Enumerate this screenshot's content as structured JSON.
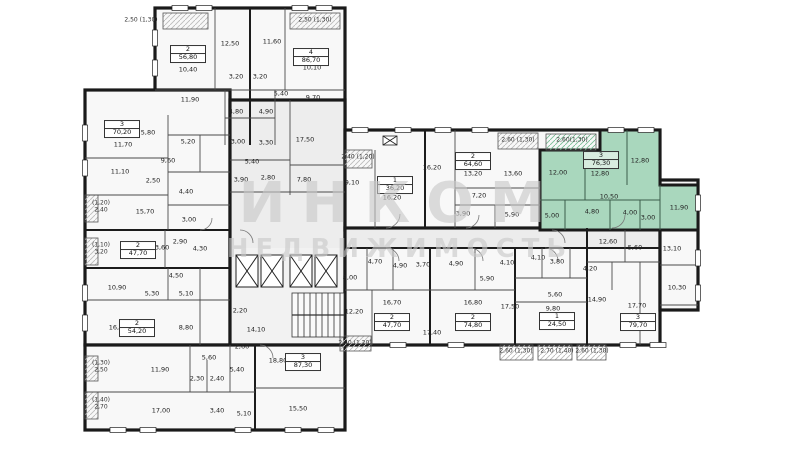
{
  "watermark": {
    "line1": "ИНКОМ",
    "line2": "НЕДВИЖИМОСТЬ"
  },
  "colors": {
    "highlight_fill": "#a9d7bd",
    "wall": "#1a1a1a",
    "watermark": "#c9c9c9"
  },
  "selected_apartment": {
    "rooms": "3",
    "area": "76,30"
  },
  "apartments": [
    {
      "n": "2",
      "a": "56,80",
      "x": 188,
      "y": 54
    },
    {
      "n": "4",
      "a": "86,70",
      "x": 311,
      "y": 57
    },
    {
      "n": "3",
      "a": "70,20",
      "x": 122,
      "y": 129
    },
    {
      "n": "2",
      "a": "47,70",
      "x": 138,
      "y": 250
    },
    {
      "n": "2",
      "a": "54,20",
      "x": 137,
      "y": 328
    },
    {
      "n": "3",
      "a": "87,30",
      "x": 303,
      "y": 362
    },
    {
      "n": "1",
      "a": "36,20",
      "x": 395,
      "y": 185
    },
    {
      "n": "2",
      "a": "64,60",
      "x": 473,
      "y": 161
    },
    {
      "n": "3",
      "a": "76,30",
      "x": 601,
      "y": 160,
      "h": true
    },
    {
      "n": "2",
      "a": "47,70",
      "x": 392,
      "y": 322
    },
    {
      "n": "2",
      "a": "74,80",
      "x": 473,
      "y": 322
    },
    {
      "n": "1",
      "a": "24,50",
      "x": 557,
      "y": 321
    },
    {
      "n": "3",
      "a": "79,70",
      "x": 638,
      "y": 322
    }
  ],
  "rooms": [
    {
      "t": "12,50",
      "x": 230,
      "y": 44
    },
    {
      "t": "11,60",
      "x": 272,
      "y": 42
    },
    {
      "t": "10,40",
      "x": 188,
      "y": 70
    },
    {
      "t": "10,10",
      "x": 312,
      "y": 68
    },
    {
      "t": "11,90",
      "x": 190,
      "y": 100
    },
    {
      "t": "3,20",
      "x": 236,
      "y": 77
    },
    {
      "t": "3,20",
      "x": 260,
      "y": 77
    },
    {
      "t": "5,40",
      "x": 281,
      "y": 94
    },
    {
      "t": "9,70",
      "x": 313,
      "y": 98
    },
    {
      "t": "4,80",
      "x": 236,
      "y": 112
    },
    {
      "t": "4,90",
      "x": 266,
      "y": 112
    },
    {
      "t": "3,00",
      "x": 238,
      "y": 142
    },
    {
      "t": "3,30",
      "x": 266,
      "y": 143
    },
    {
      "t": "17,50",
      "x": 305,
      "y": 140
    },
    {
      "t": "5,40",
      "x": 252,
      "y": 162
    },
    {
      "t": "2,80",
      "x": 268,
      "y": 178
    },
    {
      "t": "3,90",
      "x": 241,
      "y": 180
    },
    {
      "t": "7,80",
      "x": 304,
      "y": 180
    },
    {
      "t": "9,10",
      "x": 352,
      "y": 183
    },
    {
      "t": "5,80",
      "x": 148,
      "y": 133
    },
    {
      "t": "11,70",
      "x": 123,
      "y": 145
    },
    {
      "t": "5,20",
      "x": 188,
      "y": 142
    },
    {
      "t": "9,60",
      "x": 168,
      "y": 161
    },
    {
      "t": "11,10",
      "x": 120,
      "y": 172
    },
    {
      "t": "2,50",
      "x": 153,
      "y": 181
    },
    {
      "t": "4,40",
      "x": 186,
      "y": 192
    },
    {
      "t": "15,70",
      "x": 145,
      "y": 212
    },
    {
      "t": "3,00",
      "x": 189,
      "y": 220
    },
    {
      "t": "13,60",
      "x": 160,
      "y": 248
    },
    {
      "t": "2,90",
      "x": 180,
      "y": 242
    },
    {
      "t": "4,30",
      "x": 200,
      "y": 249
    },
    {
      "t": "4,50",
      "x": 176,
      "y": 276
    },
    {
      "t": "10,90",
      "x": 117,
      "y": 288
    },
    {
      "t": "5,30",
      "x": 152,
      "y": 294
    },
    {
      "t": "5,10",
      "x": 186,
      "y": 294
    },
    {
      "t": "16,50",
      "x": 118,
      "y": 328
    },
    {
      "t": "8,80",
      "x": 186,
      "y": 328
    },
    {
      "t": "2,20",
      "x": 240,
      "y": 311
    },
    {
      "t": "14,10",
      "x": 256,
      "y": 330
    },
    {
      "t": "11,90",
      "x": 160,
      "y": 370
    },
    {
      "t": "5,60",
      "x": 209,
      "y": 358
    },
    {
      "t": "2,60",
      "x": 242,
      "y": 347
    },
    {
      "t": "2,30",
      "x": 197,
      "y": 379
    },
    {
      "t": "2,40",
      "x": 217,
      "y": 379
    },
    {
      "t": "5,40",
      "x": 237,
      "y": 370
    },
    {
      "t": "18,80",
      "x": 278,
      "y": 361
    },
    {
      "t": "15,50",
      "x": 298,
      "y": 409
    },
    {
      "t": "17,00",
      "x": 161,
      "y": 411
    },
    {
      "t": "3,40",
      "x": 217,
      "y": 411
    },
    {
      "t": "5,10",
      "x": 244,
      "y": 414
    },
    {
      "t": "16,20",
      "x": 392,
      "y": 198
    },
    {
      "t": "16,20",
      "x": 432,
      "y": 168
    },
    {
      "t": "13,20",
      "x": 473,
      "y": 174
    },
    {
      "t": "13,60",
      "x": 513,
      "y": 174
    },
    {
      "t": "7,20",
      "x": 479,
      "y": 196
    },
    {
      "t": "3,90",
      "x": 463,
      "y": 214
    },
    {
      "t": "5,90",
      "x": 512,
      "y": 215
    },
    {
      "t": "12,00",
      "x": 558,
      "y": 173
    },
    {
      "t": "12,80",
      "x": 600,
      "y": 174
    },
    {
      "t": "12,80",
      "x": 640,
      "y": 161
    },
    {
      "t": "10,50",
      "x": 609,
      "y": 197
    },
    {
      "t": "4,80",
      "x": 592,
      "y": 212
    },
    {
      "t": "4,00",
      "x": 630,
      "y": 213
    },
    {
      "t": "3,00",
      "x": 648,
      "y": 218
    },
    {
      "t": "5,00",
      "x": 552,
      "y": 216
    },
    {
      "t": "11,90",
      "x": 679,
      "y": 208
    },
    {
      "t": "8,00",
      "x": 350,
      "y": 278
    },
    {
      "t": "4,70",
      "x": 375,
      "y": 262
    },
    {
      "t": "4,90",
      "x": 400,
      "y": 266
    },
    {
      "t": "12,20",
      "x": 354,
      "y": 312
    },
    {
      "t": "16,70",
      "x": 392,
      "y": 303
    },
    {
      "t": "3,70",
      "x": 423,
      "y": 265
    },
    {
      "t": "4,90",
      "x": 456,
      "y": 264
    },
    {
      "t": "17,40",
      "x": 432,
      "y": 333
    },
    {
      "t": "16,80",
      "x": 473,
      "y": 303
    },
    {
      "t": "5,90",
      "x": 487,
      "y": 279
    },
    {
      "t": "4,10",
      "x": 507,
      "y": 263
    },
    {
      "t": "4,10",
      "x": 538,
      "y": 258
    },
    {
      "t": "3,80",
      "x": 557,
      "y": 262
    },
    {
      "t": "4,20",
      "x": 590,
      "y": 269
    },
    {
      "t": "5,60",
      "x": 555,
      "y": 295
    },
    {
      "t": "9,80",
      "x": 553,
      "y": 309
    },
    {
      "t": "17,50",
      "x": 510,
      "y": 307
    },
    {
      "t": "14,90",
      "x": 597,
      "y": 300
    },
    {
      "t": "12,60",
      "x": 608,
      "y": 242
    },
    {
      "t": "5,60",
      "x": 635,
      "y": 248
    },
    {
      "t": "13,10",
      "x": 672,
      "y": 249
    },
    {
      "t": "10,30",
      "x": 677,
      "y": 288
    },
    {
      "t": "17,70",
      "x": 637,
      "y": 306
    }
  ],
  "balconies": [
    {
      "t": "2,50 (1,30)",
      "x": 141,
      "y": 21
    },
    {
      "t": "2,50 (1,30)",
      "x": 315,
      "y": 21
    },
    {
      "t": "(1,20) 2,40",
      "x": 101,
      "y": 207,
      "w": 24
    },
    {
      "t": "(1,10) 3,20",
      "x": 101,
      "y": 249,
      "w": 24
    },
    {
      "t": "(1,30) 2,50",
      "x": 101,
      "y": 367,
      "w": 24
    },
    {
      "t": "(1,40) 2,70",
      "x": 101,
      "y": 404,
      "w": 24
    },
    {
      "t": "2,40 (1,20)",
      "x": 358,
      "y": 158
    },
    {
      "t": "2,40 (1,20)",
      "x": 355,
      "y": 344
    },
    {
      "t": "2,60 (1,30)",
      "x": 518,
      "y": 141
    },
    {
      "t": "2,60(1,30)",
      "x": 572,
      "y": 141
    },
    {
      "t": "2,60 (1,30)",
      "x": 516,
      "y": 352
    },
    {
      "t": "2,70 (1,40)",
      "x": 557,
      "y": 352
    },
    {
      "t": "2,60 (1,30)",
      "x": 592,
      "y": 352
    }
  ]
}
